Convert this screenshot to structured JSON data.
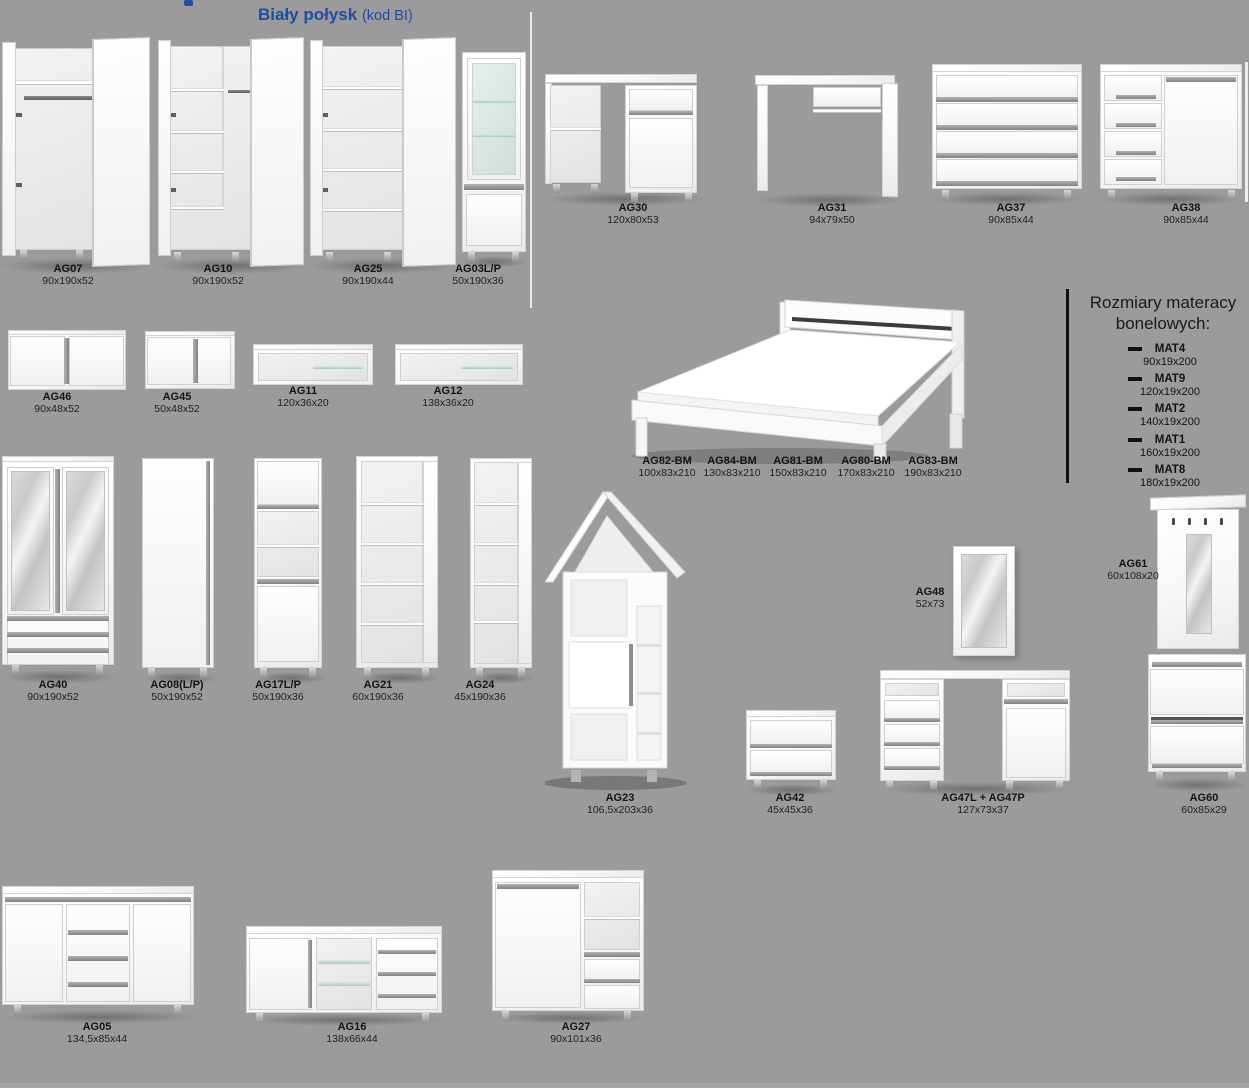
{
  "header": {
    "title": "Biały połysk",
    "subtitle": "(kod BI)"
  },
  "products": {
    "ag07": {
      "code": "AG07",
      "dims": "90x190x52"
    },
    "ag10": {
      "code": "AG10",
      "dims": "90x190x52"
    },
    "ag25": {
      "code": "AG25",
      "dims": "90x190x44"
    },
    "ag03": {
      "code": "AG03L/P",
      "dims": "50x190x36"
    },
    "ag30": {
      "code": "AG30",
      "dims": "120x80x53"
    },
    "ag31": {
      "code": "AG31",
      "dims": "94x79x50"
    },
    "ag37": {
      "code": "AG37",
      "dims": "90x85x44"
    },
    "ag38": {
      "code": "AG38",
      "dims": "90x85x44"
    },
    "ag46": {
      "code": "AG46",
      "dims": "90x48x52"
    },
    "ag45": {
      "code": "AG45",
      "dims": "50x48x52"
    },
    "ag11": {
      "code": "AG11",
      "dims": "120x36x20"
    },
    "ag12": {
      "code": "AG12",
      "dims": "138x36x20"
    },
    "ag82": {
      "code": "AG82-BM",
      "dims": "100x83x210"
    },
    "ag84": {
      "code": "AG84-BM",
      "dims": "130x83x210"
    },
    "ag81": {
      "code": "AG81-BM",
      "dims": "150x83x210"
    },
    "ag80": {
      "code": "AG80-BM",
      "dims": "170x83x210"
    },
    "ag83": {
      "code": "AG83-BM",
      "dims": "190x83x210"
    },
    "ag40": {
      "code": "AG40",
      "dims": "90x190x52"
    },
    "ag08": {
      "code": "AG08(L/P)",
      "dims": "50x190x52"
    },
    "ag17": {
      "code": "AG17L/P",
      "dims": "50x190x36"
    },
    "ag21": {
      "code": "AG21",
      "dims": "60x190x36"
    },
    "ag24": {
      "code": "AG24",
      "dims": "45x190x36"
    },
    "ag23": {
      "code": "AG23",
      "dims": "106,5x203x36"
    },
    "ag42": {
      "code": "AG42",
      "dims": "45x45x36"
    },
    "ag48": {
      "code": "AG48",
      "dims": "52x73"
    },
    "ag47": {
      "code": "AG47L + AG47P",
      "dims": "127x73x37"
    },
    "ag61": {
      "code": "AG61",
      "dims": "60x108x20"
    },
    "ag60": {
      "code": "AG60",
      "dims": "60x85x29"
    },
    "ag05": {
      "code": "AG05",
      "dims": "134,5x85x44"
    },
    "ag16": {
      "code": "AG16",
      "dims": "138x66x44"
    },
    "ag27": {
      "code": "AG27",
      "dims": "90x101x36"
    }
  },
  "mattress": {
    "title": "Rozmiary materacy bonelowych:",
    "items": [
      {
        "code": "MAT4",
        "dims": "90x19x200"
      },
      {
        "code": "MAT9",
        "dims": "120x19x200"
      },
      {
        "code": "MAT2",
        "dims": "140x19x200"
      },
      {
        "code": "MAT1",
        "dims": "160x19x200"
      },
      {
        "code": "MAT8",
        "dims": "180x19x200"
      }
    ]
  },
  "colors": {
    "background": "#9b9b9b",
    "accent_blue": "#1d4fa1",
    "furniture_white": "#fbfbfb",
    "handle_gray": "#8a8a8a",
    "mattress_rule": "#111111"
  }
}
